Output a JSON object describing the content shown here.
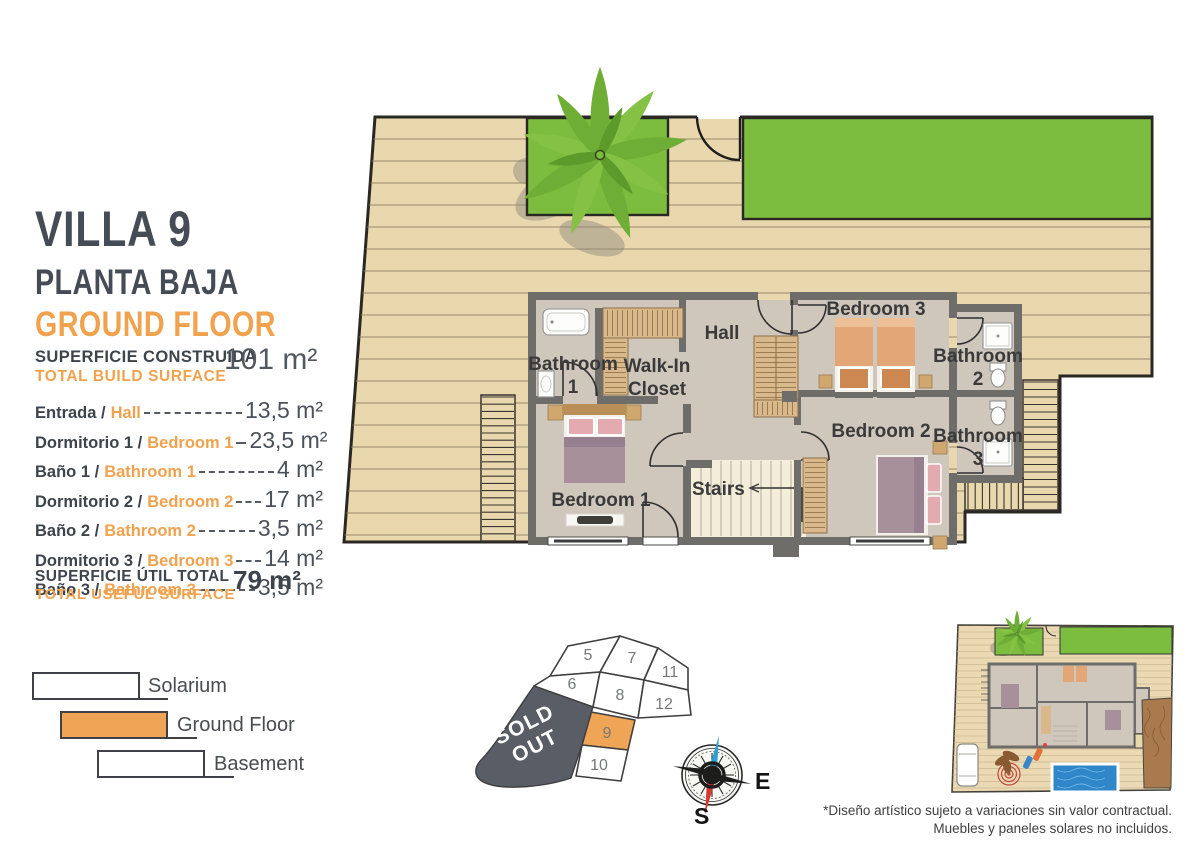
{
  "header": {
    "villa": "VILLA 9",
    "planta_es": "PLANTA BAJA",
    "planta_en": "GROUND FLOOR"
  },
  "build_surface": {
    "label_es": "SUPERFICIE CONSTRUIDA",
    "label_en": "TOTAL BUILD SURFACE",
    "value": "101 m²"
  },
  "useful_surface": {
    "label_es": "SUPERFICIE ÚTIL TOTAL",
    "label_en": "TOTAL USEFUL SURFACE",
    "value": "79 m²"
  },
  "rooms": [
    {
      "es": "Entrada /",
      "en": "Hall",
      "value": "13,5 m²"
    },
    {
      "es": "Dormitorio 1 /",
      "en": "Bedroom 1",
      "value": "23,5 m²"
    },
    {
      "es": "Baño 1 /",
      "en": "Bathroom 1",
      "value": "4 m²"
    },
    {
      "es": "Dormitorio 2 /",
      "en": "Bedroom 2",
      "value": "17 m²"
    },
    {
      "es": "Baño 2 /",
      "en": "Bathroom 2",
      "value": "3,5 m²"
    },
    {
      "es": "Dormitorio 3 /",
      "en": "Bedroom 3",
      "value": "14 m²"
    },
    {
      "es": "Baño 3 /",
      "en": "Bathroom 3",
      "value": "3,5 m²"
    }
  ],
  "legend": [
    {
      "label": "Solarium",
      "fill": "#FFFFFF"
    },
    {
      "label": "Ground Floor",
      "fill": "#F0A455"
    },
    {
      "label": "Basement",
      "fill": "#FFFFFF"
    }
  ],
  "site_map": {
    "sold_line1": "SOLD",
    "sold_line2": "OUT",
    "plots": [
      "5",
      "7",
      "11",
      "6",
      "8",
      "12",
      "9",
      "10"
    ],
    "active_plot": "9"
  },
  "compass": {
    "east": "E",
    "south": "S"
  },
  "plan": {
    "hall": "Hall",
    "bathroom1": [
      "Bathroom",
      "1"
    ],
    "walk_in": [
      "Walk-In",
      "Closet"
    ],
    "bedroom3": "Bedroom 3",
    "bathroom2": [
      "Bathroom",
      "2"
    ],
    "bedroom2": "Bedroom 2",
    "bathroom3": [
      "Bathroom",
      "3"
    ],
    "bedroom1": "Bedroom 1",
    "stairs": "Stairs"
  },
  "disclaimer_1": "*Diseño artístico sujeto a variaciones sin valor contractual.",
  "disclaimer_2": "Muebles y paneles solares no incluidos.",
  "colors": {
    "accent_orange": "#F0A24E",
    "heading": "#464C55",
    "lawn_green": "#7CBC3E",
    "deck": "#E9D7AE",
    "wall": "#6F6D6A",
    "floor": "#CFC7BC",
    "sold_bg": "#585D66",
    "pool_blue": "#2F86C8"
  }
}
